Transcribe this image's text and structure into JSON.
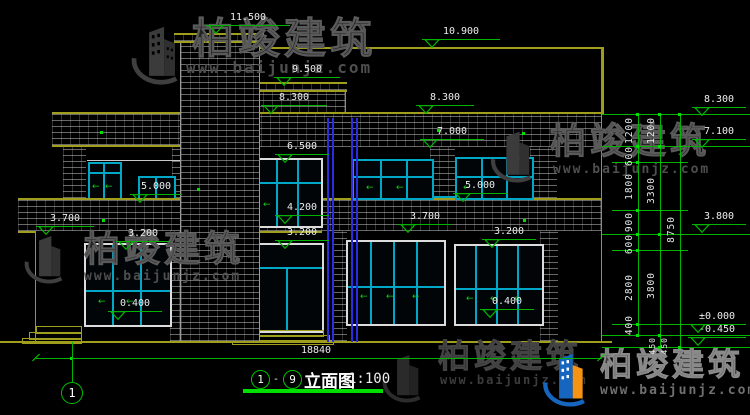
{
  "watermark": {
    "brand": "柏竣建筑",
    "url": "www.baijunjz.com"
  },
  "title_bar": {
    "grid_start": "1",
    "separator": "-",
    "grid_end": "9",
    "name": "立面图",
    "scale": "1:100"
  },
  "grid": {
    "bubble_left": "1"
  },
  "dims": {
    "total_width": "18840",
    "right_col1": [
      "1200",
      "600",
      "1800",
      "900",
      "600",
      "2800",
      "400"
    ],
    "right_col2": [
      "1200",
      "3300",
      "3800",
      "450"
    ],
    "right_col3": [
      "8750"
    ],
    "footer_extra": "450"
  },
  "levels": {
    "l11500": "11.500",
    "l10900": "10.900",
    "l9500": "9.500",
    "l8300_center": "8.300",
    "l8300_right": "8.300",
    "l8300_far": "8.300",
    "l7000": "7.000",
    "l7100": "7.100",
    "l6500": "6.500",
    "l5000_left": "5.000",
    "l5000_right": "5.000",
    "l4200": "4.200",
    "l3700_left": "3.700",
    "l3700_right": "3.700",
    "l3800": "3.800",
    "l3200_left": "3.200",
    "l3200_center": "3.200",
    "l3200_right": "3.200",
    "l0400_left": "0.400",
    "l0400_right": "0.400",
    "l_zero": "±0.000",
    "l_neg": "-0.450"
  },
  "icons": {
    "slide_arrow": "←"
  },
  "colors": {
    "background": "#000000",
    "cad_yellow": "#9f9f1d",
    "dim_green": "#00b400",
    "window_cyan": "#00a8c8",
    "frame_white": "#dcdcdc",
    "downspout_blue": "#2b2bdf"
  }
}
